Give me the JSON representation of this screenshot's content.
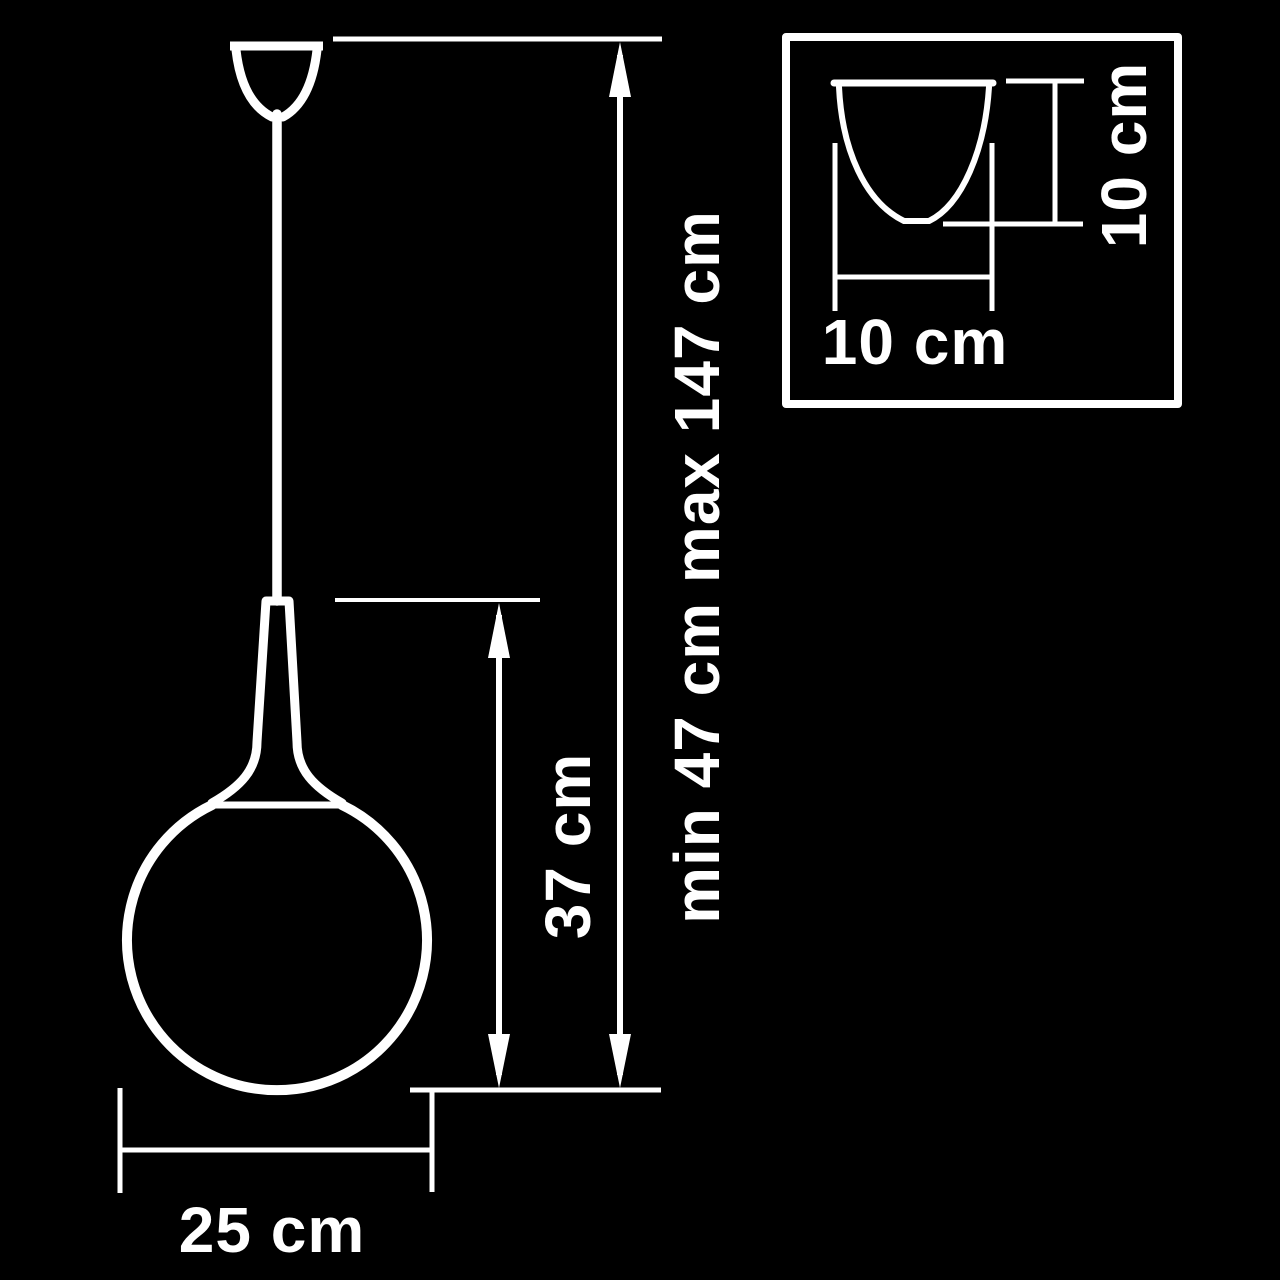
{
  "colors": {
    "background": "#000000",
    "ink": "#ffffff"
  },
  "main_view": {
    "total_height_label": "min 47 cm max 147 cm",
    "shade_height_label": "37 cm",
    "shade_diameter_label": "25 cm"
  },
  "inset_view": {
    "canopy_width_label": "10 cm",
    "canopy_height_label": "10 cm"
  }
}
